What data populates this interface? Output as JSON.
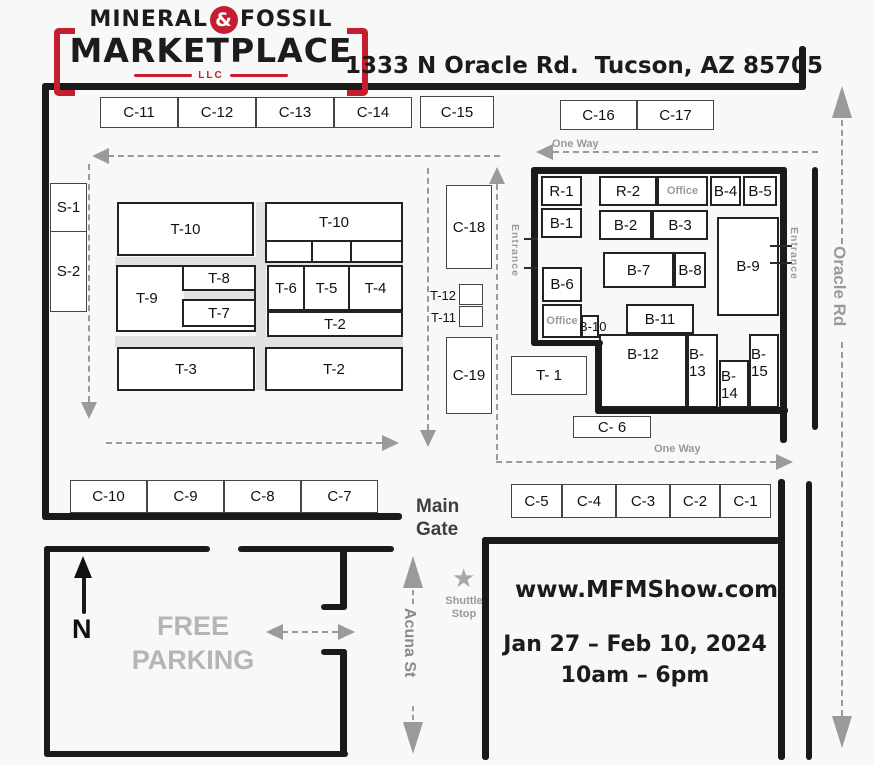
{
  "logo": {
    "word1": "MINERAL",
    "amp": "&",
    "word2": "FOSSIL",
    "word3": "MARKETPLACE",
    "word4": "LLC"
  },
  "address": "1333 N Oracle Rd.  Tucson, AZ 85705",
  "event": {
    "website": "www.MFMShow.com",
    "dates": "Jan 27 – Feb 10, 2024",
    "hours": "10am – 6pm"
  },
  "labels": {
    "one_way": "One Way",
    "entrance": "Entrance",
    "main_gate": "Main Gate",
    "free_parking": "FREE PARKING",
    "shuttle_stop": "Shuttle Stop",
    "acuna_st": "Acuna St",
    "oracle_rd": "Oracle Rd",
    "north": "N",
    "star_icon": "★"
  },
  "booths": {
    "row_top": {
      "c11": "C-11",
      "c12": "C-12",
      "c13": "C-13",
      "c14": "C-14",
      "c15": "C-15",
      "c16": "C-16",
      "c17": "C-17"
    },
    "street_side": {
      "s1": "S-1",
      "s2": "S-2"
    },
    "tents": {
      "t10a": "T-10",
      "t10b": "T-10",
      "t9": "T-9",
      "t8": "T-8",
      "t7": "T-7",
      "t6": "T-6",
      "t5": "T-5",
      "t4": "T-4",
      "t3": "T-3",
      "t2a": "T-2",
      "t2b": "T-2",
      "t12": "T-12",
      "t11": "T-11",
      "t1": "T- 1"
    },
    "mid_row": {
      "c18": "C-18",
      "c19": "C-19"
    },
    "building": {
      "r1": "R-1",
      "r2": "R-2",
      "office_top": "Office",
      "b4": "B-4",
      "b5": "B-5",
      "b1": "B-1",
      "b2": "B-2",
      "b3": "B-3",
      "b6": "B-6",
      "b7": "B-7",
      "b8": "B-8",
      "b9": "B-9",
      "office_side": "Office",
      "b10": "B-10",
      "b11": "B-11",
      "b12": "B-12",
      "b13": "B-13",
      "b14": "B-14",
      "b15": "B-15"
    },
    "row_bottom_left": {
      "c10": "C-10",
      "c9": "C-9",
      "c8": "C-8",
      "c7": "C-7"
    },
    "row_bottom_right": {
      "c5": "C-5",
      "c4": "C-4",
      "c3": "C-3",
      "c2": "C-2",
      "c1": "C-1"
    },
    "c6": "C- 6"
  },
  "colors": {
    "accent_red": "#c41f30",
    "wall_black": "#1a1a1a",
    "dash_gray": "#9a9a9a",
    "aisle_gray": "#e1e1e1",
    "muted_text": "#9a9a9a"
  }
}
